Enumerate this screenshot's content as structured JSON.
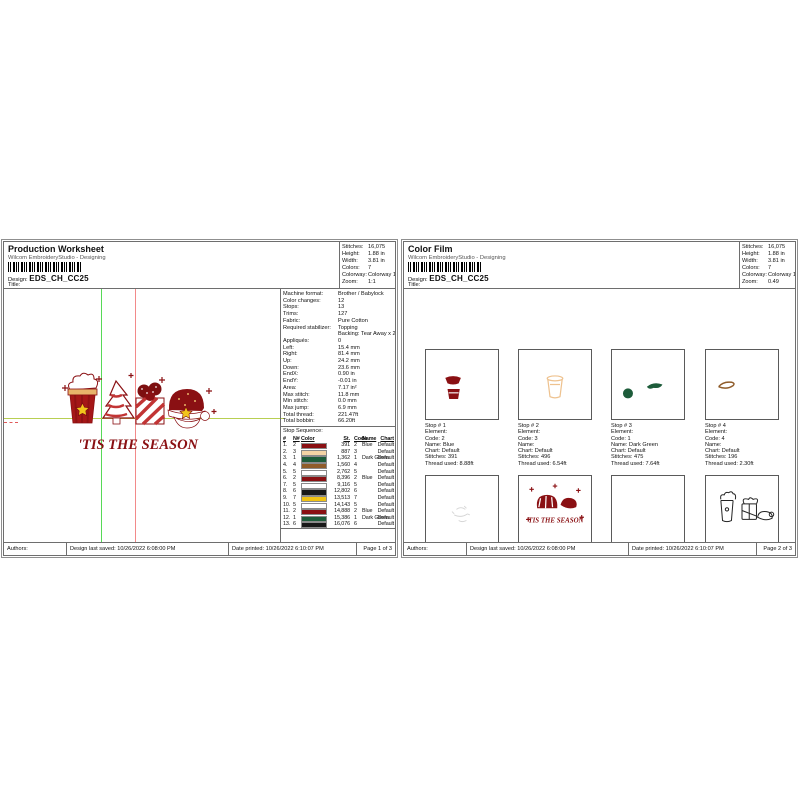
{
  "artwork": {
    "tagline": "'TIS THE SEASON"
  },
  "left": {
    "title": "Production Worksheet",
    "app": "Wilcom EmbroideryStudio - Designing",
    "design_label": "Design:",
    "design_value": "EDS_CH_CC25",
    "title_label": "Title:",
    "stats": [
      {
        "label": "Stitches:",
        "value": "16,075"
      },
      {
        "label": "Height:",
        "value": "1.88 in"
      },
      {
        "label": "Width:",
        "value": "3.81 in"
      },
      {
        "label": "Colors:",
        "value": "7"
      },
      {
        "label": "Colorway:",
        "value": "Colorway 1"
      },
      {
        "label": "Zoom:",
        "value": "1:1"
      }
    ],
    "details": [
      {
        "label": "Machine format:",
        "value": "Brother / Babylock"
      },
      {
        "label": "Color changes:",
        "value": "12"
      },
      {
        "label": "Stops:",
        "value": "13"
      },
      {
        "label": "Trims:",
        "value": "127"
      },
      {
        "label": "Fabric:",
        "value": "Pure Cotton"
      },
      {
        "label": "Required stabilizer:",
        "value": "Topping"
      },
      {
        "label": "",
        "value": "Backing: Tear Away x 2"
      },
      {
        "label": "Appliqués:",
        "value": "0"
      },
      {
        "label": "Left:",
        "value": "15.4 mm"
      },
      {
        "label": "Right:",
        "value": "81.4 mm"
      },
      {
        "label": "Up:",
        "value": "24.2 mm"
      },
      {
        "label": "Down:",
        "value": "23.6 mm"
      },
      {
        "label": "EndX:",
        "value": "0.90 in"
      },
      {
        "label": "EndY:",
        "value": "-0.01 in"
      },
      {
        "label": "Area:",
        "value": "7.17 in²"
      },
      {
        "label": "Max stitch:",
        "value": "11.8 mm"
      },
      {
        "label": "Min stitch:",
        "value": "0.0 mm"
      },
      {
        "label": "Max jump:",
        "value": "6.9 mm"
      },
      {
        "label": "Total thread:",
        "value": "221.47ft"
      },
      {
        "label": "Total bobbin:",
        "value": "66.20ft"
      }
    ],
    "stop_sequence_label": "Stop Sequence:",
    "stop_table": {
      "headers": [
        "#",
        "N#",
        "Color",
        "St.",
        "Code",
        "Name",
        "Chart"
      ],
      "rows": [
        {
          "num": "1.",
          "needle": "2",
          "color": "#8a1013",
          "st": "391",
          "code": "2",
          "name": "Blue",
          "chart": "Default"
        },
        {
          "num": "2.",
          "needle": "3",
          "color": "#f4d3a5",
          "st": "887",
          "code": "3",
          "name": "",
          "chart": "Default"
        },
        {
          "num": "3.",
          "needle": "1",
          "color": "#1d5c3a",
          "st": "1,362",
          "code": "1",
          "name": "Dark Green",
          "chart": "Default"
        },
        {
          "num": "4.",
          "needle": "4",
          "color": "#8f5c2a",
          "st": "1,560",
          "code": "4",
          "name": "",
          "chart": "Default"
        },
        {
          "num": "5.",
          "needle": "5",
          "color": "#ffffff",
          "st": "2,762",
          "code": "5",
          "name": "",
          "chart": "Default"
        },
        {
          "num": "6.",
          "needle": "2",
          "color": "#8a1013",
          "st": "8,396",
          "code": "2",
          "name": "Blue",
          "chart": "Default"
        },
        {
          "num": "7.",
          "needle": "5",
          "color": "#ffffff",
          "st": "9,116",
          "code": "5",
          "name": "",
          "chart": "Default"
        },
        {
          "num": "8.",
          "needle": "6",
          "color": "#181818",
          "st": "12,802",
          "code": "6",
          "name": "",
          "chart": "Default"
        },
        {
          "num": "9.",
          "needle": "7",
          "color": "#f0c213",
          "st": "13,513",
          "code": "7",
          "name": "",
          "chart": "Default"
        },
        {
          "num": "10.",
          "needle": "5",
          "color": "#ffffff",
          "st": "14,143",
          "code": "5",
          "name": "",
          "chart": "Default"
        },
        {
          "num": "11.",
          "needle": "2",
          "color": "#8a1013",
          "st": "14,888",
          "code": "2",
          "name": "Blue",
          "chart": "Default"
        },
        {
          "num": "12.",
          "needle": "1",
          "color": "#1d5c3a",
          "st": "15,386",
          "code": "1",
          "name": "Dark Green",
          "chart": "Default"
        },
        {
          "num": "13.",
          "needle": "6",
          "color": "#181818",
          "st": "16,076",
          "code": "6",
          "name": "",
          "chart": "Default"
        }
      ]
    },
    "footer": {
      "authors": "Authors:",
      "saved": "Design last saved:  10/26/2022 6:08:00 PM",
      "printed": "Date printed:  10/26/2022 6:10:07 PM",
      "page": "Page 1 of 3"
    }
  },
  "right": {
    "title": "Color Film",
    "app": "Wilcom EmbroideryStudio - Designing",
    "design_label": "Design:",
    "design_value": "EDS_CH_CC25",
    "title_label": "Title:",
    "stats": [
      {
        "label": "Stitches:",
        "value": "16,075"
      },
      {
        "label": "Height:",
        "value": "1.88 in"
      },
      {
        "label": "Width:",
        "value": "3.81 in"
      },
      {
        "label": "Colors:",
        "value": "7"
      },
      {
        "label": "Colorway:",
        "value": "Colorway 1"
      },
      {
        "label": "Zoom:",
        "value": "0.49"
      }
    ],
    "cells": [
      {
        "lines": [
          "Stop # 1",
          "Element:",
          "Code: 2",
          "Name: Blue",
          "Chart: Default",
          "Stitches: 391",
          "Thread used: 8.88ft"
        ]
      },
      {
        "lines": [
          "Stop # 2",
          "Element:",
          "Code: 3",
          "Name:",
          "Chart: Default",
          "Stitches: 496",
          "Thread used: 6.54ft"
        ]
      },
      {
        "lines": [
          "Stop # 3",
          "Element:",
          "Code: 1",
          "Name: Dark Green",
          "Chart: Default",
          "Stitches: 475",
          "Thread used: 7.64ft"
        ]
      },
      {
        "lines": [
          "Stop # 4",
          "Element:",
          "Code: 4",
          "Name:",
          "Chart: Default",
          "Stitches: 196",
          "Thread used: 2.30ft"
        ]
      },
      {
        "lines": [
          "Stop # 5",
          "Element:",
          "Code: 5",
          "Name:",
          "Chart: Default",
          "Stitches: 1,202",
          "Thread used: 18.34ft"
        ]
      },
      {
        "lines": [
          "Stop # 6",
          "Element:",
          "Code: 2",
          "Name: Blue",
          "Chart: Default",
          "Stitches: 5,634",
          "Thread used: 78.66ft"
        ]
      },
      {
        "lines": [
          "Stop # 7",
          "Element:",
          "Code: 5",
          "Name:",
          "Chart: Default",
          "Stitches: 720",
          "Thread used: 13.29ft"
        ]
      },
      {
        "lines": [
          "Stop # 8",
          "Element:",
          "Code: 6",
          "Name:",
          "Chart: Default",
          "Stitches: 3,686",
          "Thread used: 42.37ft"
        ]
      }
    ],
    "footer": {
      "authors": "Authors:",
      "saved": "Design last saved:  10/26/2022 6:08:00 PM",
      "printed": "Date printed:  10/26/2022 6:10:07 PM",
      "page": "Page 2 of 3"
    }
  }
}
